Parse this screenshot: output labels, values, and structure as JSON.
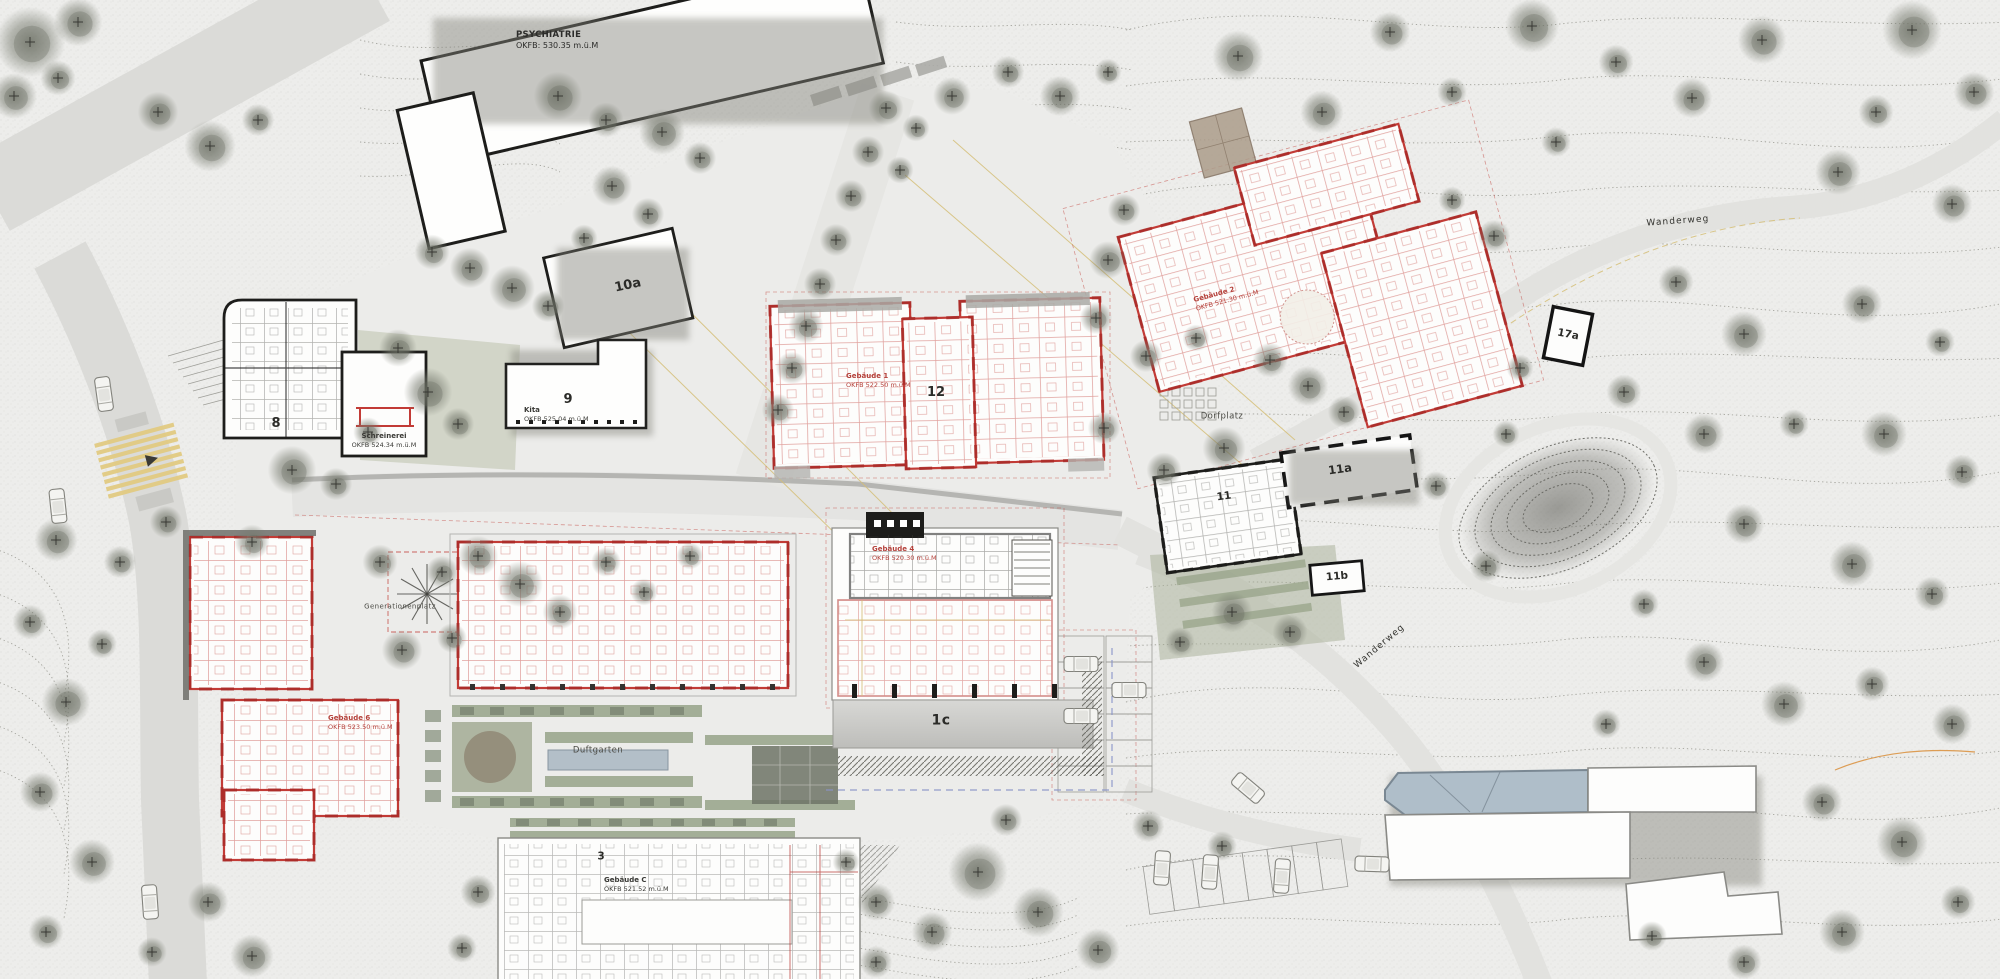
{
  "plan": {
    "type": "architectural-site-plan",
    "labels": {
      "psychiatrie_title": "PSYCHIATRIE",
      "psychiatrie_elev": "OKFB: 530.35 m.ü.M",
      "b10a": "10a",
      "b9_num": "9",
      "b9_name": "Kita",
      "b9_elev": "OKFB 525.04 m.ü.M",
      "b8_num": "8",
      "schreinerei_name": "Schreinerei",
      "schreinerei_elev": "OKFB 524.34 m.ü.M",
      "b12_num": "12",
      "geb1_name": "Gebäude 1",
      "geb1_elev": "OKFB 522.50 m.ü.M",
      "geb2_name": "Gebäude 2",
      "geb2_elev": "OKFB 521.30 m.ü.M",
      "geb4_name": "Gebäude 4",
      "geb4_elev": "OKFB 520.30 m.ü.M",
      "geb6_name": "Gebäude 6",
      "geb6_elev": "OKFB 523.50 m.ü.M",
      "gebC_name": "Gebäude C",
      "gebC_elev": "OKFB 521.52 m.ü.M",
      "b17a": "17a",
      "b11_num": "11",
      "b11a": "11a",
      "b11b": "11b",
      "b1c": "1c",
      "b3_num": "3",
      "dorfplatz": "Dorfplatz",
      "wanderweg_upper": "Wanderweg",
      "wanderweg_lower": "Wanderweg",
      "duftgarten": "Duftgarten",
      "generationenplatz": "Generationenplatz"
    },
    "colors": {
      "paper": "#EDEDEB",
      "road": "#DBDBD8",
      "new_plan_red": "#C23B36",
      "existing_black": "#1D1D1B",
      "contour_grey": "#97978F",
      "tree_grey": "#6F7367",
      "lawn_green": "#B8BEA6",
      "hedge_green": "#97A388",
      "water_blue": "#B3BFC8",
      "roof_blue_grey": "#AFBEC9",
      "utility_yellow": "#D5BE77",
      "crosswalk_yellow": "#E2CA82"
    }
  }
}
